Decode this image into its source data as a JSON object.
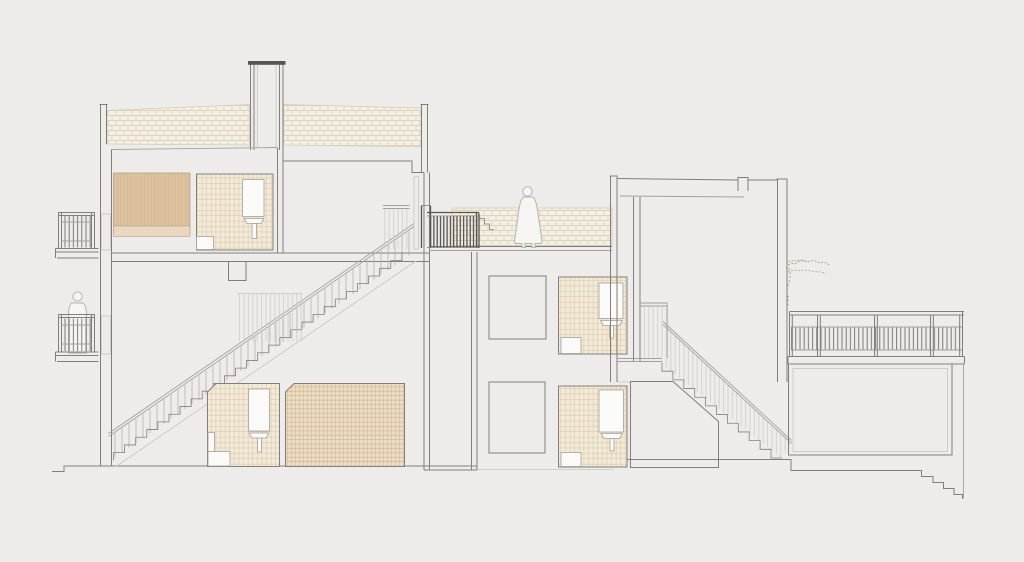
{
  "meta": {
    "title": "Architectural cross-section drawing of a multi-level residential building",
    "drawing_type": "section-elevation",
    "visible_text": []
  },
  "canvas": {
    "width": 1024,
    "height": 562,
    "background": "#edecea"
  },
  "colors": {
    "bg": "#edecea",
    "line_main": "#827f7a",
    "line_light": "#a5a19a",
    "line_xlight": "#c9c5be",
    "line_dark": "#57554f",
    "brick_base": "#f4efe5",
    "brick_joint": "#d7cab1",
    "tile_base": "#f2ead9",
    "tile_line": "#d9c2a1",
    "dense_base": "#ebdcc2",
    "dense_line": "#cdb390",
    "tan_fill": "#dcc29f",
    "tan_line": "#cfb38c",
    "tan_band": "#e9d8bf",
    "tan_stroke": "#b6a486",
    "white_fixture": "#fafaf8",
    "rail_dark": "#4b4945",
    "rail_mid": "#6f6d68",
    "rail_light": "#b6b2ab",
    "rail_xlight": "#ccc8c1",
    "figure_fill": "#f6f5f3",
    "figure_line": "#b7b3ac",
    "plant": "#a98f6b"
  },
  "inventory": {
    "left_building": [
      "chimney",
      "roof-insulation-bands",
      "parapets",
      "juliet-balcony-upper",
      "juliet-balcony-lower",
      "balcony-figure",
      "bedroom-wardrobe",
      "bathroom-upper-left",
      "main-staircase",
      "bathroom-lower-left",
      "tiled-room-lower"
    ],
    "middle": [
      "roof-terrace",
      "terrace-brick-parapet",
      "terrace-figure",
      "terrace-dark-railing",
      "terrace-steps",
      "elevator-shaft",
      "plain-room-upper",
      "plain-room-lower",
      "bathroom-middle-upper",
      "bathroom-middle-lower"
    ],
    "right_building": [
      "tall-block",
      "stairwell-wall",
      "stairwell-guard-railing",
      "interior-staircase",
      "chamfered-room",
      "hanging-plant",
      "long-balcony-railing",
      "balcony-slab",
      "lower-wing-room",
      "terrain-steps"
    ],
    "fixtures": [
      "mirror",
      "washbasin",
      "shower-tray"
    ]
  }
}
